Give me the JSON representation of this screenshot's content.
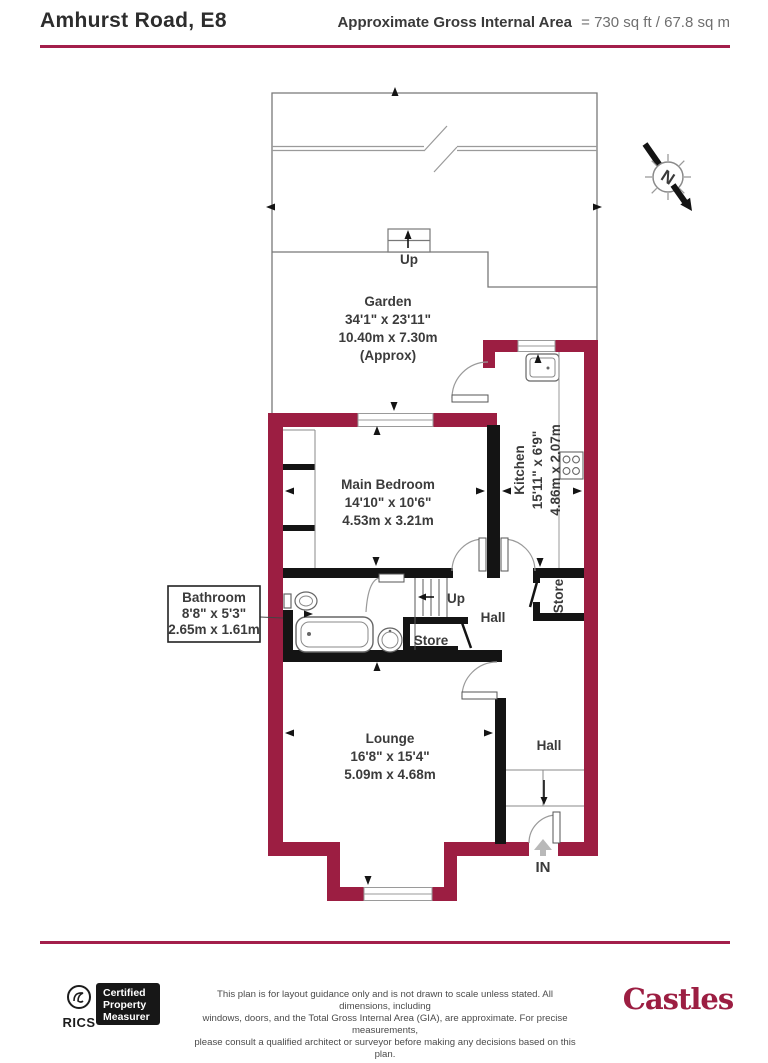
{
  "header": {
    "title": "Amhurst Road, E8",
    "area_label": "Approximate Gross Internal Area",
    "area_value": "= 730 sq ft / 67.8 sq m"
  },
  "colors": {
    "exterior_wall": "#9C1E42",
    "accent_rule": "#A31F4B",
    "interior_wall": "#141414",
    "label_text": "#3b3b3b",
    "muted_text": "#6f6f6f"
  },
  "compass": {
    "label": "N"
  },
  "rooms": {
    "garden": {
      "name": "Garden",
      "dims_imperial": "34'1\" x 23'11\"",
      "dims_metric": "10.40m x 7.30m",
      "note": "(Approx)"
    },
    "main_bedroom": {
      "name": "Main Bedroom",
      "dims_imperial": "14'10\" x 10'6\"",
      "dims_metric": "4.53m x 3.21m"
    },
    "kitchen": {
      "name": "Kitchen",
      "dims_imperial": "15'11\" x 6'9\"",
      "dims_metric": "4.86m x 2.07m"
    },
    "bathroom": {
      "name": "Bathroom",
      "dims_imperial": "8'8\" x 5'3\"",
      "dims_metric": "2.65m x 1.61m"
    },
    "lounge": {
      "name": "Lounge",
      "dims_imperial": "16'8\" x 15'4\"",
      "dims_metric": "5.09m x 4.68m"
    },
    "hall_upper": "Hall",
    "hall_lower": "Hall",
    "store_mid": "Store",
    "store_side": "Store"
  },
  "labels": {
    "up_garden": "Up",
    "up_stairs": "Up",
    "entrance": "IN"
  },
  "footer": {
    "rics_label": "RICS",
    "badge_lines": [
      "Certified",
      "Property",
      "Measurer"
    ],
    "disclaimer_lines": [
      "This plan is for layout guidance only and is not drawn to scale unless stated. All dimensions, including",
      "windows, doors, and the Total Gross Internal Area (GIA), are approximate. For precise measurements,",
      "please consult a qualified architect or surveyor before making any decisions based on this plan."
    ],
    "logo_text": "Castles"
  }
}
